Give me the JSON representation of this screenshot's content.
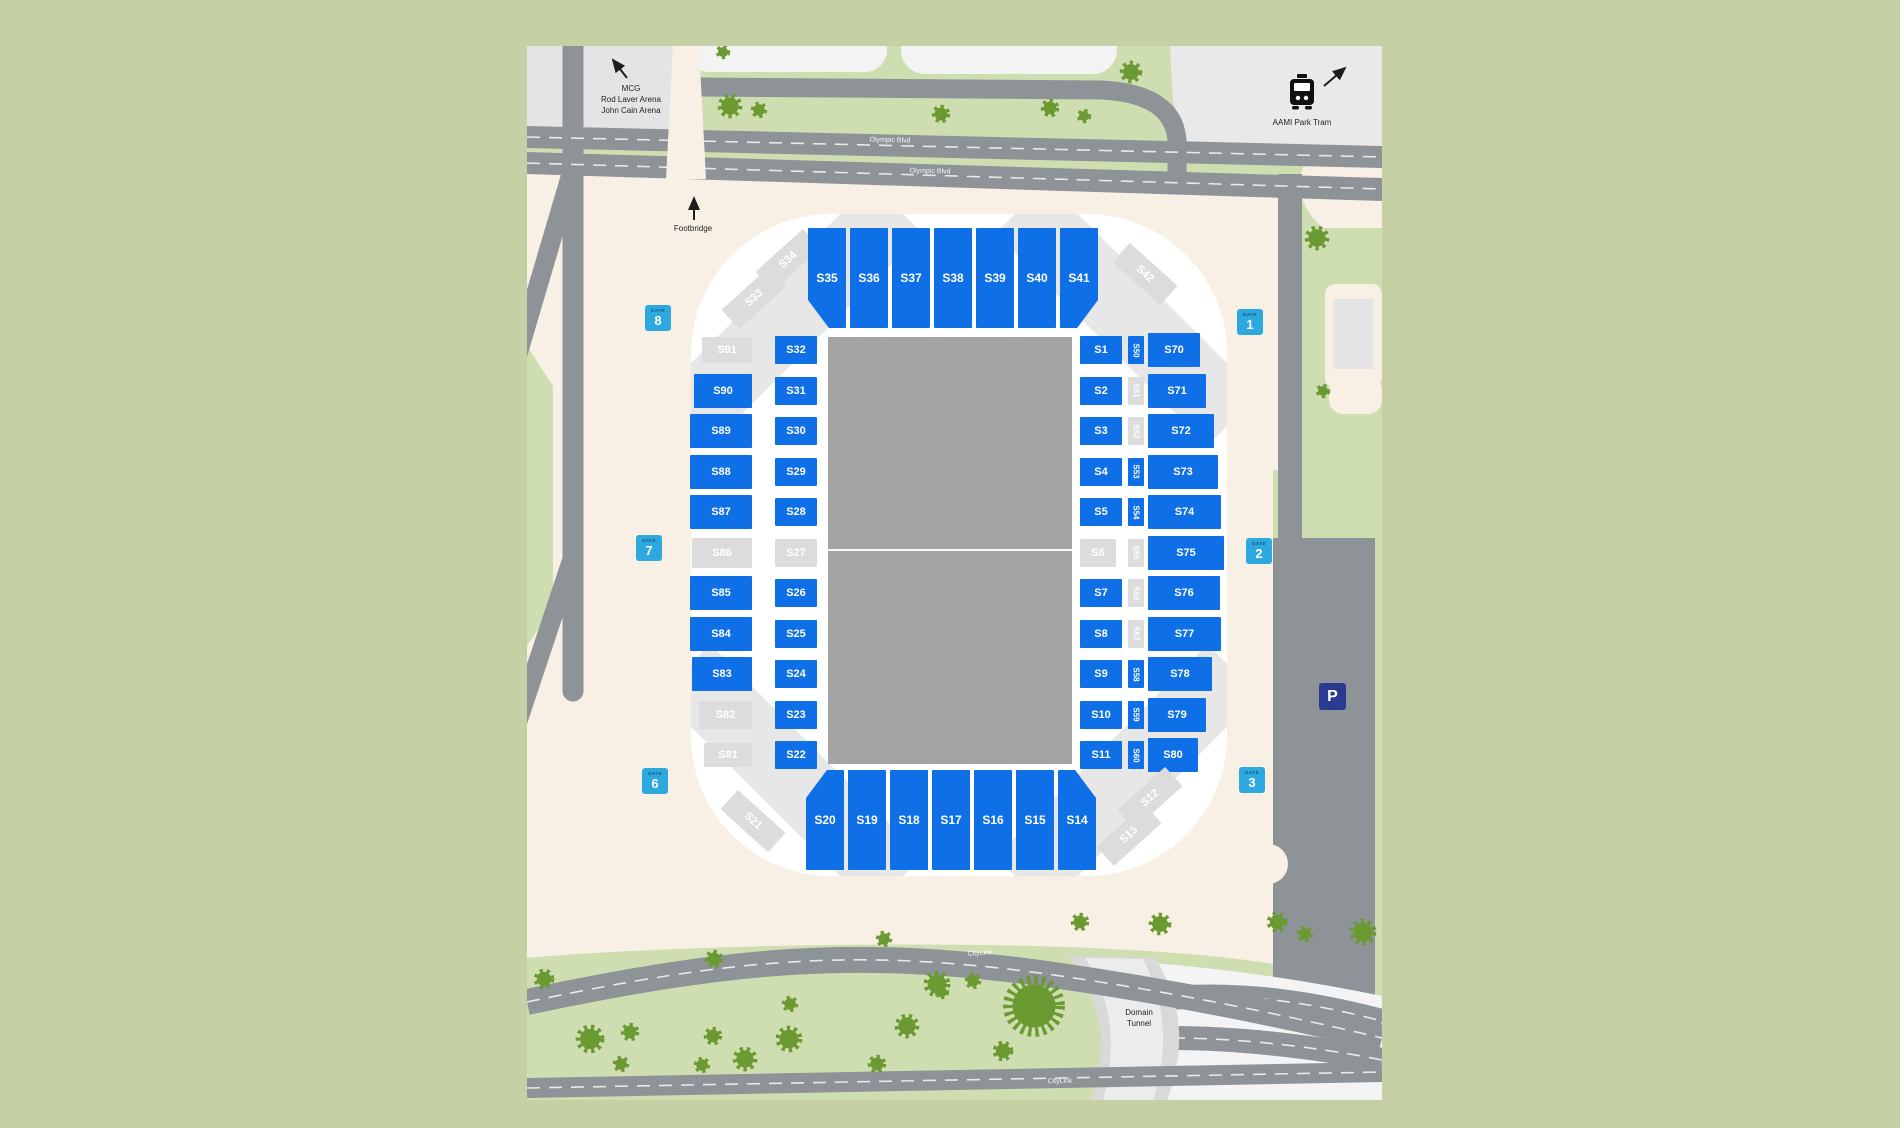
{
  "colors": {
    "page_green": "#c5d1a5",
    "map_green": "#cfdeb1",
    "cream": "#f8f0e4",
    "road": "#8d9397",
    "block_gray": "#e4e4e4",
    "tree": "#6b9a33",
    "section_available": "#0e6fe6",
    "section_unavailable": "#dcdcdc",
    "pitch": "#a4a4a4",
    "bowl": "#ffffff",
    "gate_badge": "#2da9e0",
    "gate_word": "#14537f",
    "parking_badge": "#2b3a90"
  },
  "map": {
    "labels": {
      "mcg_line1": "MCG",
      "mcg_line2": "Rod Laver Arena",
      "mcg_line3": "John Cain Arena",
      "footbridge": "Footbridge",
      "tram": "AAMI Park Tram",
      "olympic_blvd_1": "Olympic Blvd",
      "olympic_blvd_2": "Olympic Blvd",
      "citylink_1": "CityLink",
      "citylink_2": "CityLink",
      "domain_tunnel_line1": "Domain",
      "domain_tunnel_line2": "Tunnel",
      "parking": "P"
    },
    "gates": [
      {
        "word": "GATE",
        "number": "1"
      },
      {
        "word": "GATE",
        "number": "2"
      },
      {
        "word": "GATE",
        "number": "3"
      },
      {
        "word": "GATE",
        "number": "6"
      },
      {
        "word": "GATE",
        "number": "7"
      },
      {
        "word": "GATE",
        "number": "8"
      }
    ]
  },
  "stadium": {
    "sections": [
      {
        "id": "S34",
        "label": "S34",
        "status": "unavailable"
      },
      {
        "id": "S33",
        "label": "S33",
        "status": "unavailable"
      },
      {
        "id": "S35",
        "label": "S35",
        "status": "available"
      },
      {
        "id": "S36",
        "label": "S36",
        "status": "available"
      },
      {
        "id": "S37",
        "label": "S37",
        "status": "available"
      },
      {
        "id": "S38",
        "label": "S38",
        "status": "available"
      },
      {
        "id": "S39",
        "label": "S39",
        "status": "available"
      },
      {
        "id": "S40",
        "label": "S40",
        "status": "available"
      },
      {
        "id": "S41",
        "label": "S41",
        "status": "available"
      },
      {
        "id": "S42",
        "label": "S42",
        "status": "unavailable"
      },
      {
        "id": "S91",
        "label": "S91",
        "status": "unavailable"
      },
      {
        "id": "S90",
        "label": "S90",
        "status": "available"
      },
      {
        "id": "S89",
        "label": "S89",
        "status": "available"
      },
      {
        "id": "S88",
        "label": "S88",
        "status": "available"
      },
      {
        "id": "S87",
        "label": "S87",
        "status": "available"
      },
      {
        "id": "S86",
        "label": "S86",
        "status": "unavailable"
      },
      {
        "id": "S85",
        "label": "S85",
        "status": "available"
      },
      {
        "id": "S84",
        "label": "S84",
        "status": "available"
      },
      {
        "id": "S83",
        "label": "S83",
        "status": "available"
      },
      {
        "id": "S82",
        "label": "S82",
        "status": "unavailable"
      },
      {
        "id": "S81",
        "label": "S81",
        "status": "unavailable"
      },
      {
        "id": "S32",
        "label": "S32",
        "status": "available"
      },
      {
        "id": "S31",
        "label": "S31",
        "status": "available"
      },
      {
        "id": "S30",
        "label": "S30",
        "status": "available"
      },
      {
        "id": "S29",
        "label": "S29",
        "status": "available"
      },
      {
        "id": "S28",
        "label": "S28",
        "status": "available"
      },
      {
        "id": "S27",
        "label": "S27",
        "status": "unavailable"
      },
      {
        "id": "S26",
        "label": "S26",
        "status": "available"
      },
      {
        "id": "S25",
        "label": "S25",
        "status": "available"
      },
      {
        "id": "S24",
        "label": "S24",
        "status": "available"
      },
      {
        "id": "S23",
        "label": "S23",
        "status": "available"
      },
      {
        "id": "S22",
        "label": "S22",
        "status": "available"
      },
      {
        "id": "S1",
        "label": "S1",
        "status": "available"
      },
      {
        "id": "S2",
        "label": "S2",
        "status": "available"
      },
      {
        "id": "S3",
        "label": "S3",
        "status": "available"
      },
      {
        "id": "S4",
        "label": "S4",
        "status": "available"
      },
      {
        "id": "S5",
        "label": "S5",
        "status": "available"
      },
      {
        "id": "S6",
        "label": "S6",
        "status": "unavailable"
      },
      {
        "id": "S7",
        "label": "S7",
        "status": "available"
      },
      {
        "id": "S8",
        "label": "S8",
        "status": "available"
      },
      {
        "id": "S9",
        "label": "S9",
        "status": "available"
      },
      {
        "id": "S10",
        "label": "S10",
        "status": "available"
      },
      {
        "id": "S11",
        "label": "S11",
        "status": "available"
      },
      {
        "id": "S50",
        "label": "S50",
        "status": "available"
      },
      {
        "id": "S51",
        "label": "S51",
        "status": "unavailable"
      },
      {
        "id": "S52",
        "label": "S52",
        "status": "unavailable"
      },
      {
        "id": "S53",
        "label": "S53",
        "status": "available"
      },
      {
        "id": "S54",
        "label": "S54",
        "status": "available"
      },
      {
        "id": "S55",
        "label": "S55",
        "status": "unavailable"
      },
      {
        "id": "S56",
        "label": "S56",
        "status": "unavailable"
      },
      {
        "id": "S57",
        "label": "S57",
        "status": "unavailable"
      },
      {
        "id": "S58",
        "label": "S58",
        "status": "available"
      },
      {
        "id": "S59",
        "label": "S59",
        "status": "available"
      },
      {
        "id": "S60",
        "label": "S60",
        "status": "available"
      },
      {
        "id": "S70",
        "label": "S70",
        "status": "available"
      },
      {
        "id": "S71",
        "label": "S71",
        "status": "available"
      },
      {
        "id": "S72",
        "label": "S72",
        "status": "available"
      },
      {
        "id": "S73",
        "label": "S73",
        "status": "available"
      },
      {
        "id": "S74",
        "label": "S74",
        "status": "available"
      },
      {
        "id": "S75",
        "label": "S75",
        "status": "available"
      },
      {
        "id": "S76",
        "label": "S76",
        "status": "available"
      },
      {
        "id": "S77",
        "label": "S77",
        "status": "available"
      },
      {
        "id": "S78",
        "label": "S78",
        "status": "available"
      },
      {
        "id": "S79",
        "label": "S79",
        "status": "available"
      },
      {
        "id": "S80",
        "label": "S80",
        "status": "available"
      },
      {
        "id": "S21",
        "label": "S21",
        "status": "unavailable"
      },
      {
        "id": "S20",
        "label": "S20",
        "status": "available"
      },
      {
        "id": "S19",
        "label": "S19",
        "status": "available"
      },
      {
        "id": "S18",
        "label": "S18",
        "status": "available"
      },
      {
        "id": "S17",
        "label": "S17",
        "status": "available"
      },
      {
        "id": "S16",
        "label": "S16",
        "status": "available"
      },
      {
        "id": "S15",
        "label": "S15",
        "status": "available"
      },
      {
        "id": "S14",
        "label": "S14",
        "status": "available"
      },
      {
        "id": "S13",
        "label": "S13",
        "status": "unavailable"
      },
      {
        "id": "S12",
        "label": "S12",
        "status": "unavailable"
      }
    ]
  }
}
